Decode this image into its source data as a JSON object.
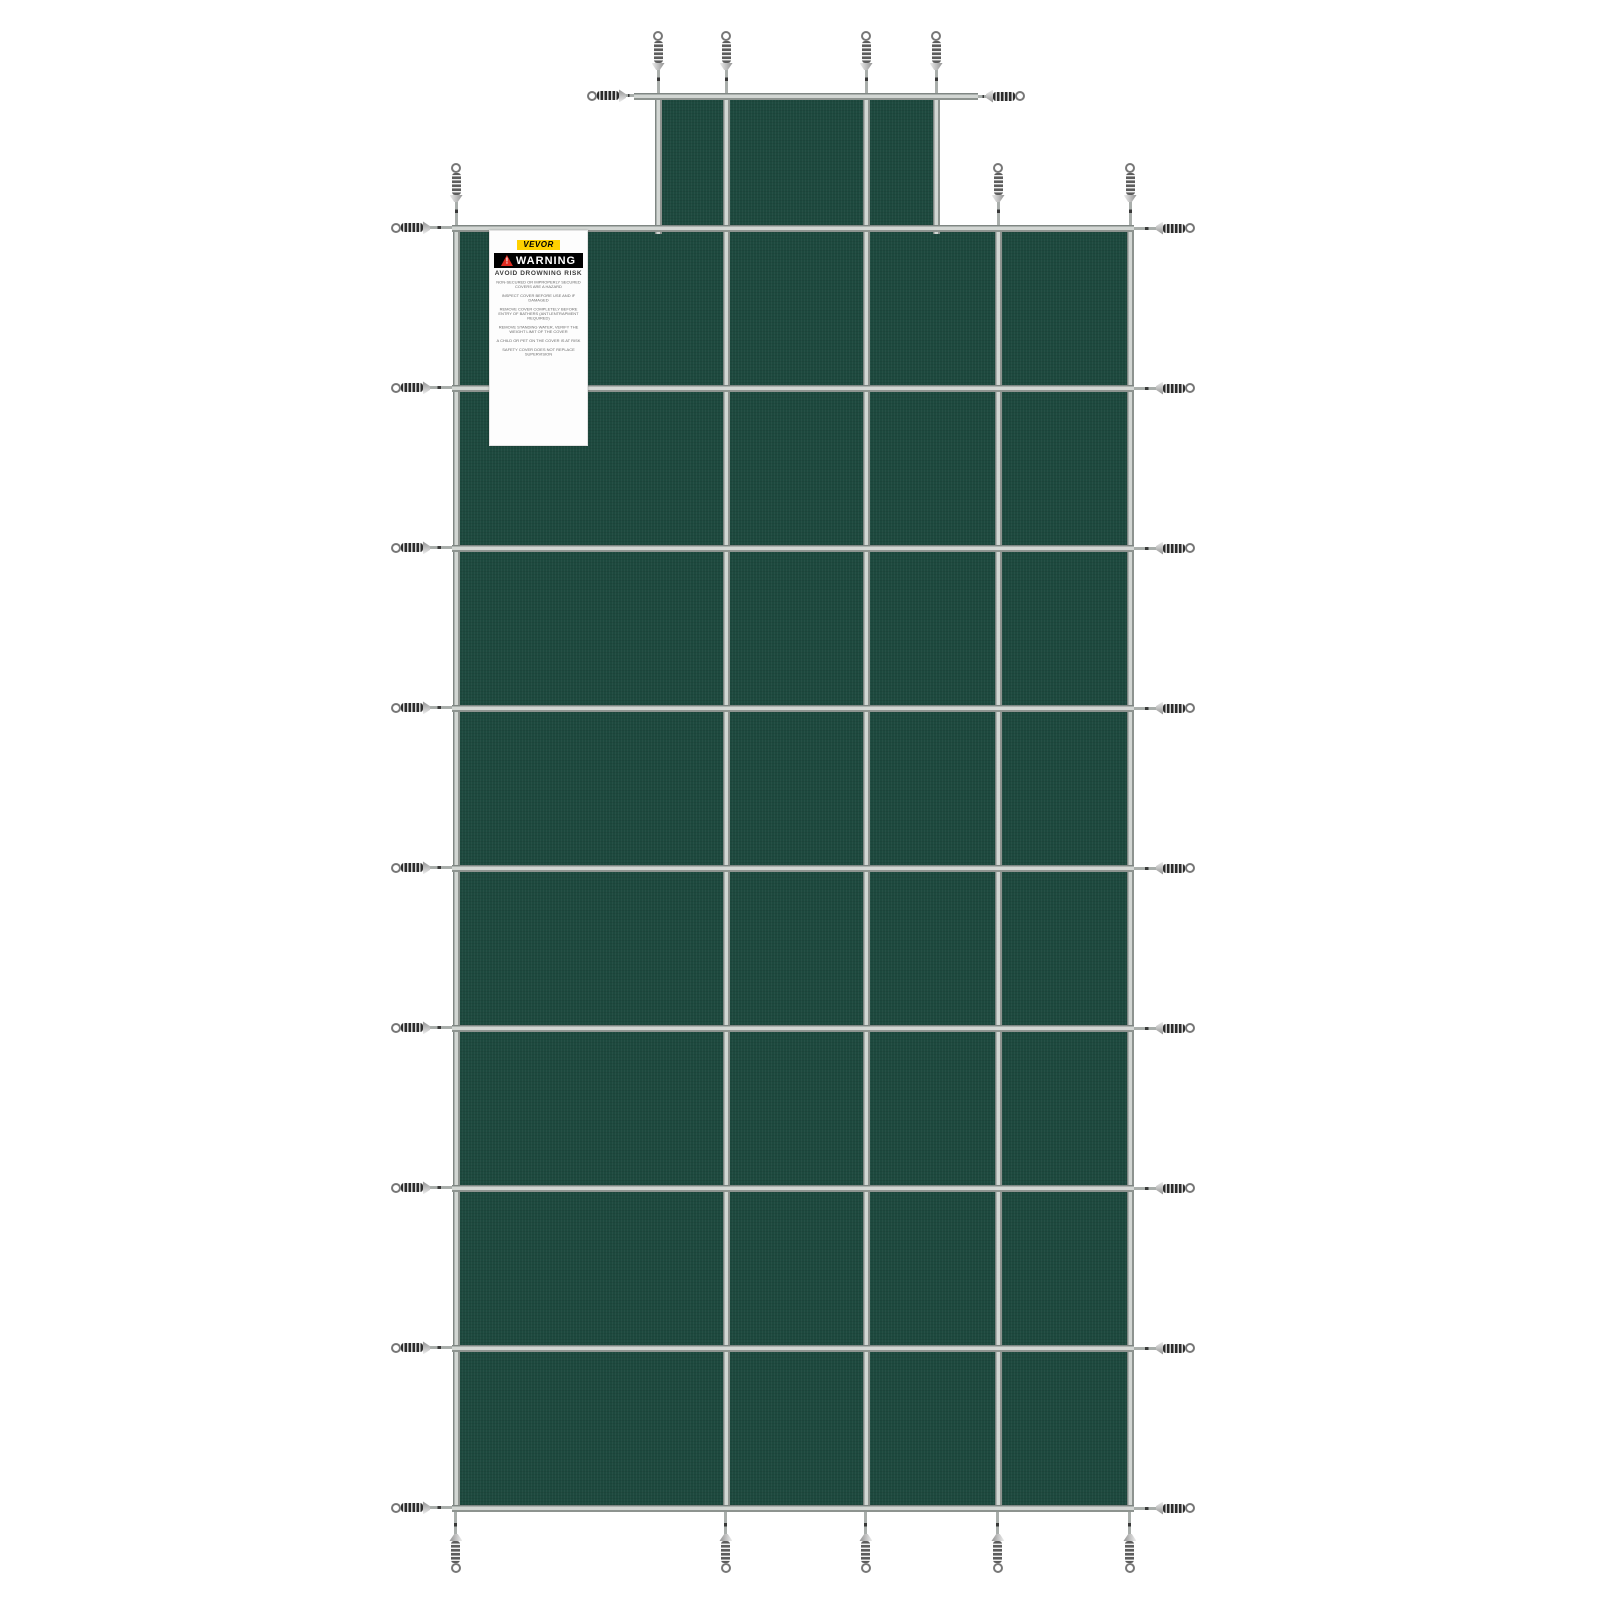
{
  "scene": {
    "description": "Green mesh rectangular pool safety cover with center step section, gray strap grid and perimeter tension springs on white background",
    "background": "#ffffff"
  },
  "cover": {
    "color": "#1d493e",
    "strap_color": "#b7bcb9",
    "main": {
      "x": 456,
      "y": 228,
      "w": 674,
      "h": 1280
    },
    "step": {
      "x": 658,
      "y": 96,
      "w": 278,
      "h": 135
    },
    "col_xs": [
      456,
      726,
      866,
      998,
      1130
    ],
    "row_ys": [
      228,
      388,
      548,
      708,
      868,
      1028,
      1188,
      1348,
      1508
    ],
    "step_col_xs": [
      658,
      726,
      866,
      936
    ],
    "bar": {
      "x1": 634,
      "x2": 978,
      "y": 96
    }
  },
  "springs": {
    "top_bar_up_xs": [
      658,
      726,
      866,
      936
    ],
    "top_edge_up_xs": [
      456,
      998,
      1130
    ],
    "bottom_down_xs": [
      456,
      726,
      866,
      998,
      1130
    ]
  },
  "label": {
    "box": {
      "x": 489,
      "y": 230,
      "w": 99,
      "h": 104
    },
    "brand": "VEVOR",
    "warning_title": "WARNING",
    "warning_icon": "warning-triangle-icon",
    "subtitle": "AVOID DROWNING RISK",
    "brand_bg": "#ffd100",
    "bar_bg": "#000000",
    "triangle_red": "#e02b20",
    "lines": [
      "NON-SECURED OR IMPROPERLY SECURED COVERS ARE A HAZARD",
      "INSPECT COVER BEFORE USE AND IF DAMAGED",
      "REMOVE COVER COMPLETELY BEFORE ENTRY OF BATHERS (ANTI-ENTRAPMENT REQUIRED)",
      "REMOVE STANDING WATER, VERIFY THE WEIGHT LIMIT OF THE COVER",
      "A CHILD OR PET ON THE COVER IS AT RISK",
      "SAFETY COVER DOES NOT REPLACE SUPERVISION"
    ]
  }
}
